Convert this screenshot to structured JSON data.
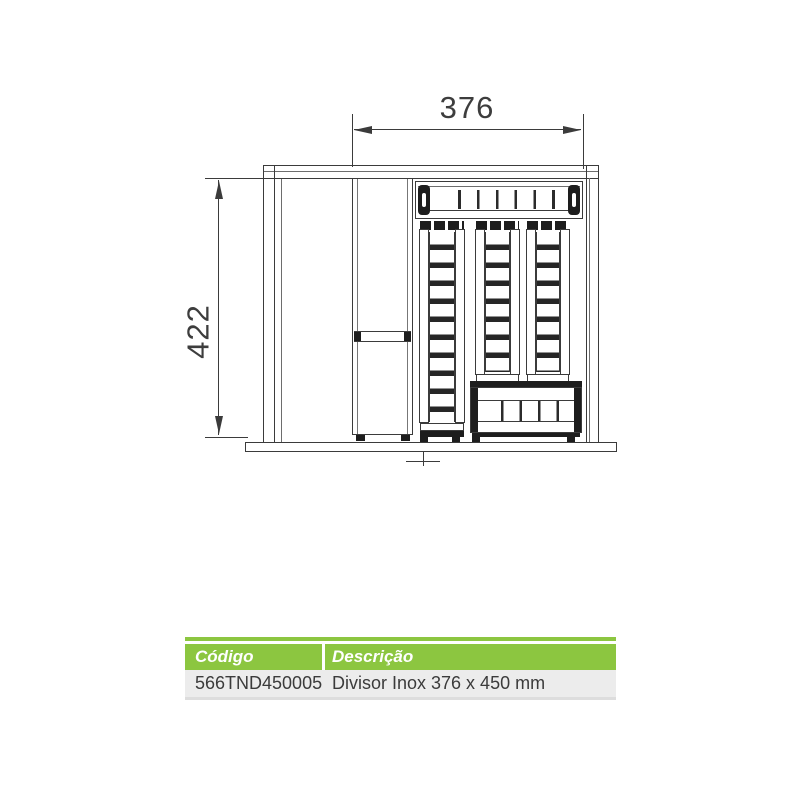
{
  "drawing": {
    "width_dim": "376",
    "height_dim": "422"
  },
  "table": {
    "headers": {
      "code": "Código",
      "description": "Descrição"
    },
    "rows": [
      {
        "code": "566TND450005",
        "description": "Divisor Inox 376 x 450 mm"
      }
    ]
  },
  "colors": {
    "accent_green": "#8CC640",
    "row_bg": "#ECECEC",
    "line_dark": "#3B3B3B",
    "fill_black": "#1D1D1D"
  }
}
